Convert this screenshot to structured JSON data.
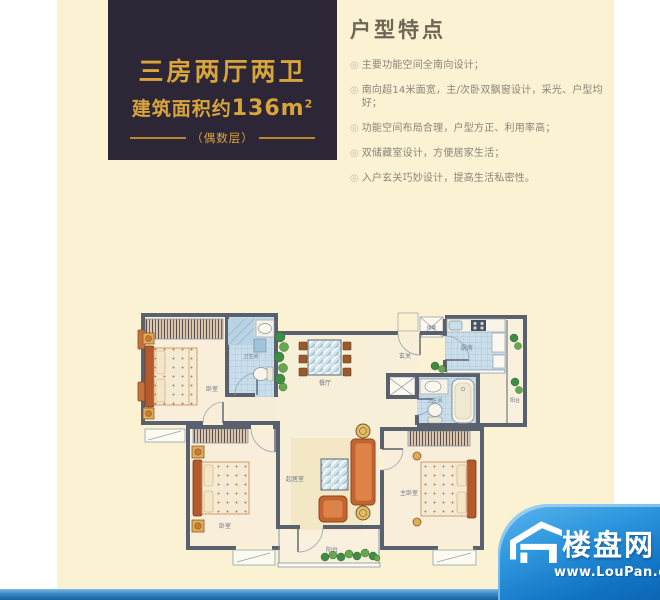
{
  "title_box": {
    "line1": "三房两厅两卫",
    "area_prefix": "建筑面积约",
    "area_value": "136m",
    "area_sup": "2",
    "line3": "（偶数层）"
  },
  "features": {
    "heading": "户型特点",
    "bullet": "◎",
    "items": [
      "主要功能空间全南向设计；",
      "南向超14米面宽，主/次卧双飘窗设计，采光、户型均好；",
      "功能空间布局合理，户型方正、利用率高；",
      "双储藏室设计，方便居家生活；",
      "入户玄关巧妙设计，提高生活私密性。"
    ]
  },
  "floorplan": {
    "rooms": [
      {
        "label": "卧室"
      },
      {
        "label": "卫生间"
      },
      {
        "label": "餐厅"
      },
      {
        "label": "玄关"
      },
      {
        "label": "储藏"
      },
      {
        "label": "厨房"
      },
      {
        "label": "阳台"
      },
      {
        "label": "卫生间"
      },
      {
        "label": "卧室"
      },
      {
        "label": "起居室"
      },
      {
        "label": "主卧室"
      },
      {
        "label": "阳台"
      }
    ]
  },
  "watermark": {
    "site_name": "楼盘网",
    "url": "www.LouPan.com"
  },
  "colors": {
    "accent_gold": "#D8A43C",
    "title_box_bg": "#2C2637",
    "panel_bg": "#FAF2D3",
    "logo_blue": "#1173C4",
    "wall": "#59616E"
  }
}
